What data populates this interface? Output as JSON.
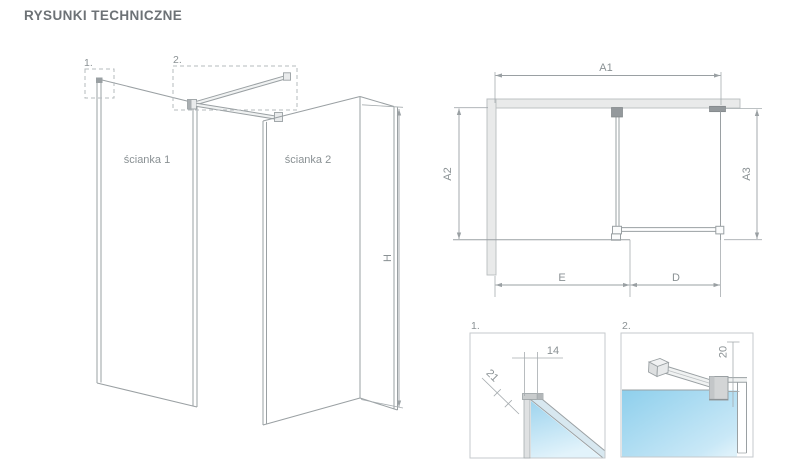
{
  "title": "RYSUNKI TECHNICZNE",
  "colors": {
    "line": "#9aa0a3",
    "text": "#8a9194",
    "title": "#6d7276",
    "wall_fill": "#e9eaea",
    "bracket_fill": "#94999c",
    "glass_blue_dark": "#8ecfec",
    "glass_blue_light": "#ddf1fa"
  },
  "iso": {
    "panel1_label": "ścianka 1",
    "panel2_label": "ścianka 2",
    "marker1": "1.",
    "marker2": "2.",
    "dim_h": "H"
  },
  "top": {
    "dim_a1": "A1",
    "dim_a2": "A2",
    "dim_a3": "A3",
    "dim_e": "E",
    "dim_d": "D"
  },
  "detail1": {
    "marker": "1.",
    "dim14": "14",
    "dim21": "21"
  },
  "detail2": {
    "marker": "2.",
    "dim20": "20"
  }
}
